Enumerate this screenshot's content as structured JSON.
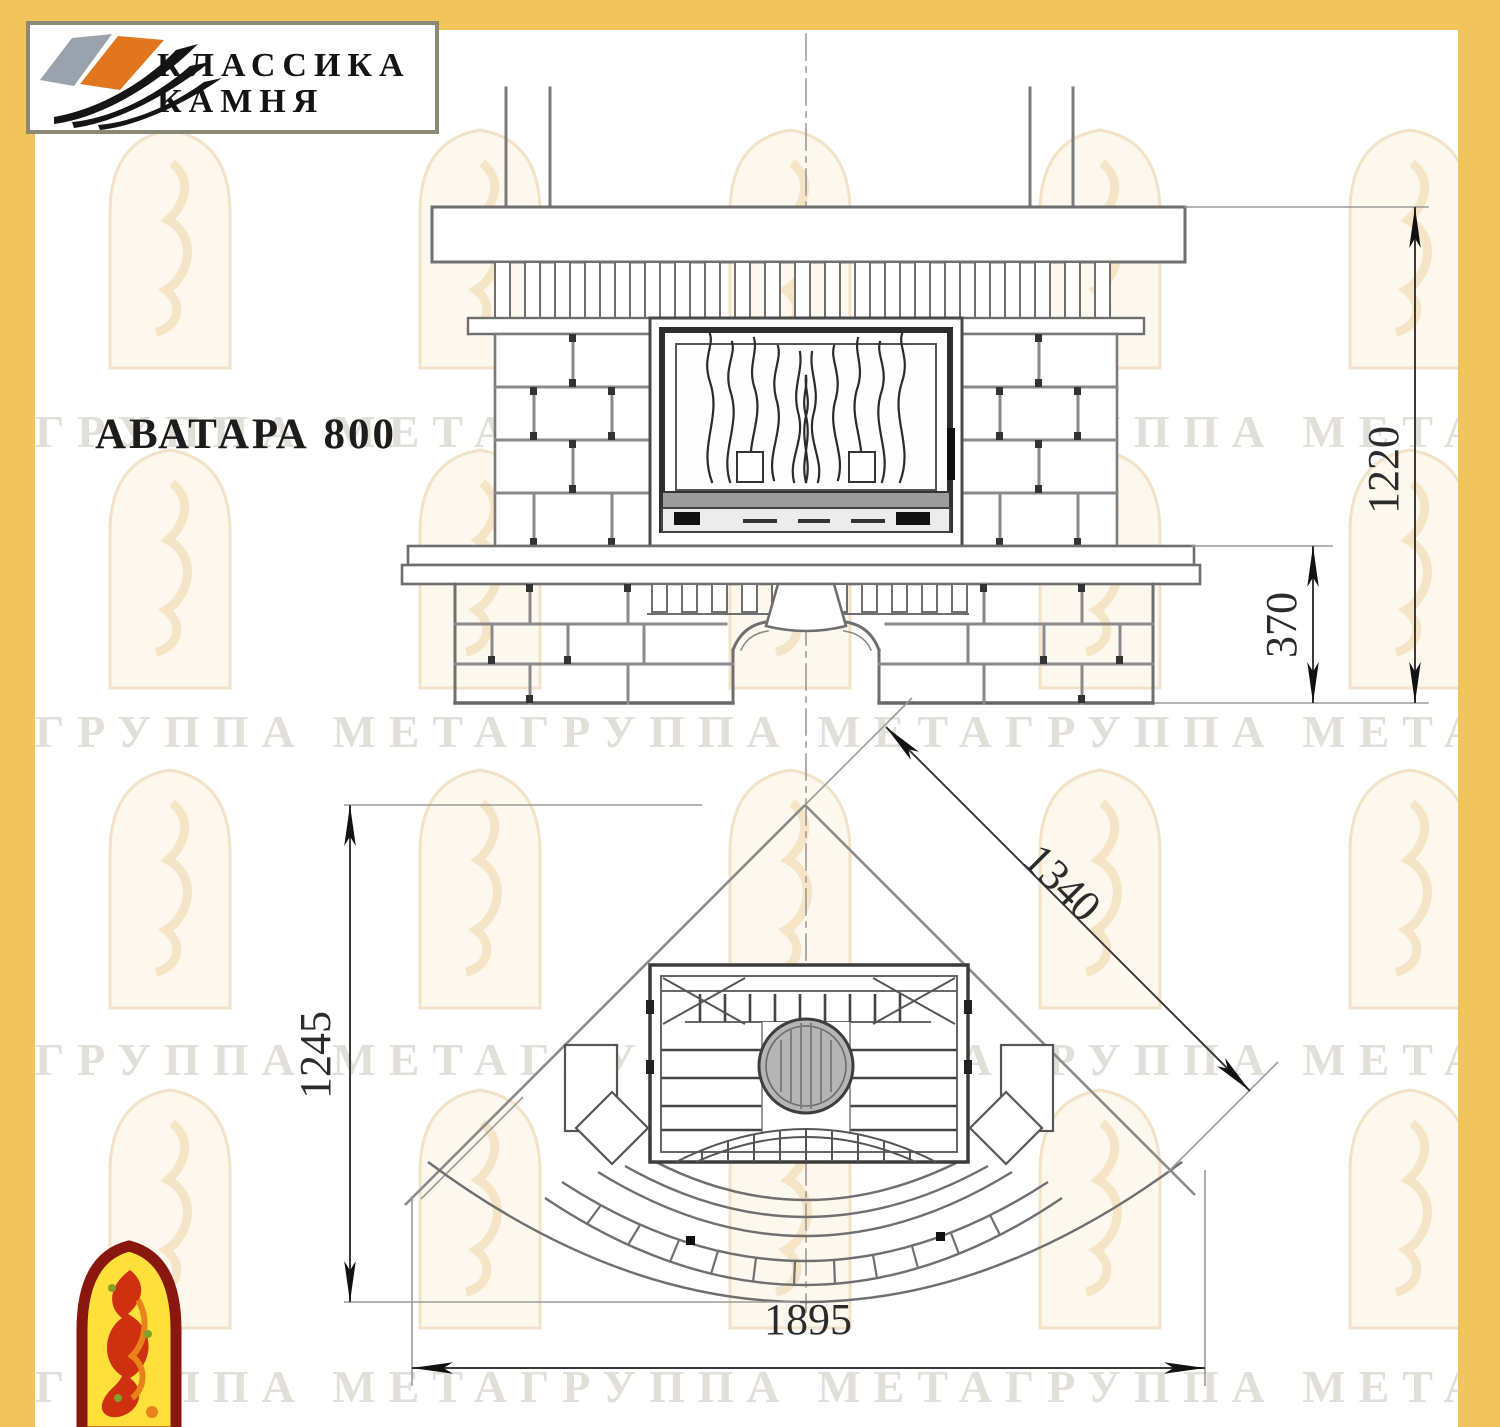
{
  "brand": {
    "logo_line1": "КЛАССИКА",
    "logo_line2": "КАМНЯ"
  },
  "model_label": "АВАТАРА 800",
  "watermark_text": "ГРУППА МЕТАГРУППА МЕТАГРУППА МЕТА",
  "dimensions": {
    "total_height": "1220",
    "bench_height": "370",
    "side_depth": "1245",
    "corner_diagonal": "1340",
    "front_width": "1895"
  },
  "colors": {
    "border_yellow": "#f2c55c",
    "drawing_line": "#6f6f6f",
    "logo_orange": "#e2761e",
    "emblem_border_red": "#8a170e",
    "emblem_yellow": "#ffdf3a",
    "emblem_flame_red": "#cf3010"
  }
}
